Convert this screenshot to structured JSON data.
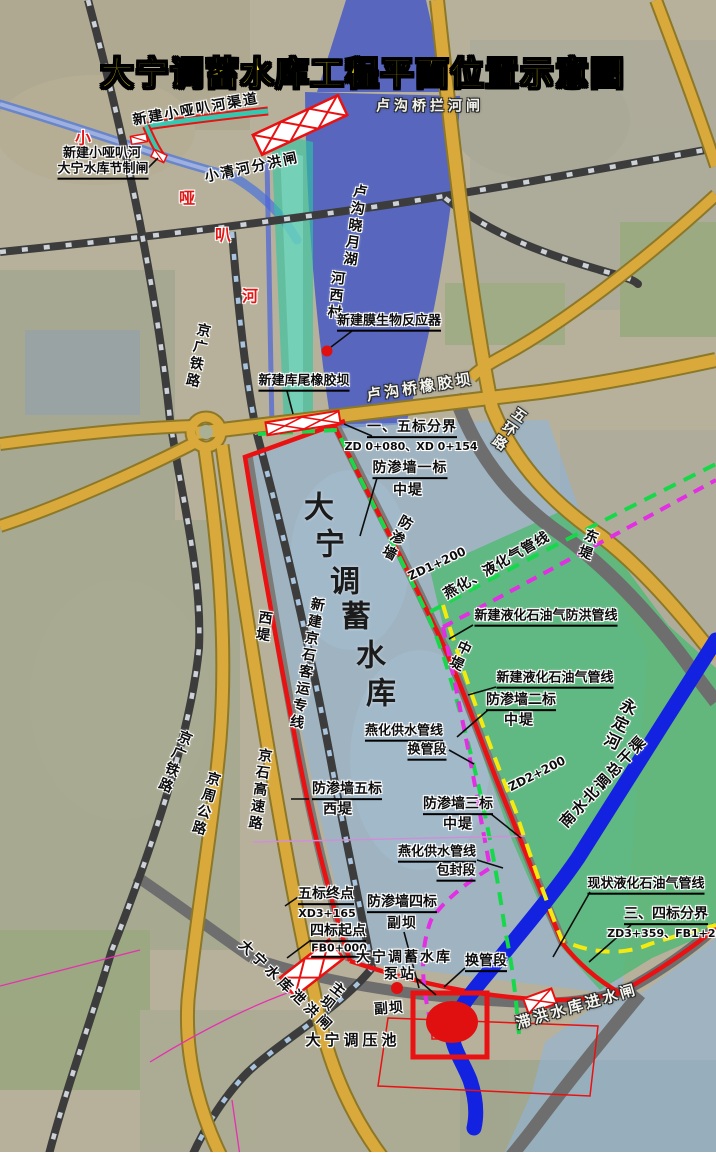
{
  "title": {
    "text": "大宁调蓄水库工程平面位置示意图"
  },
  "colors": {
    "title_yellow": "#ffe400",
    "dike_red": "#e91111",
    "pipeline_green_dashed": "#17d84b",
    "pipeline_magenta_dashed": "#e32ee3",
    "pipeline_yellow_dashed": "#f4ea10",
    "canal_blue": "#1322e0",
    "road_yellow": "#d9a93c",
    "lake_blue": "#4055c5",
    "reservoir_blue": "#8fb4d8",
    "floodplain_green": "#55b877",
    "channel_teal": "#2fc6a3"
  },
  "labels": [
    {
      "n": "label-new-xiaoyaba-channel",
      "t": "新建小哑叭河渠道",
      "x": 196,
      "y": 110,
      "r": -10,
      "c": "dark",
      "fs": 14,
      "ls": 2
    },
    {
      "n": "label-lugouqiao-lanhezha",
      "t": "卢沟桥拦河闸",
      "x": 430,
      "y": 107,
      "c": "white",
      "fs": 14,
      "ls": 4
    },
    {
      "n": "label-xiaoqinghe-fenhongzha",
      "t": "小清河分洪闸",
      "x": 252,
      "y": 168,
      "r": -12,
      "c": "dark",
      "fs": 14,
      "ls": 2
    },
    {
      "n": "label-jiezhizha-line1",
      "t": "新建小哑叭河",
      "x": 102,
      "y": 154,
      "c": "dark",
      "fs": 13
    },
    {
      "n": "label-jiezhizha-line2",
      "t": "大宁水库节制闸",
      "x": 103,
      "y": 171,
      "c": "dark u",
      "fs": 13
    },
    {
      "n": "label-xiaoyaba-he-1",
      "t": "小",
      "x": 83,
      "y": 139,
      "c": "red",
      "fs": 16
    },
    {
      "n": "label-xiaoyaba-he-2",
      "t": "哑",
      "x": 187,
      "y": 199,
      "c": "red",
      "fs": 16
    },
    {
      "n": "label-xiaoyaba-he-3",
      "t": "叭",
      "x": 223,
      "y": 236,
      "c": "red",
      "fs": 16
    },
    {
      "n": "label-xiaoyaba-he-4",
      "t": "河",
      "x": 250,
      "y": 297,
      "c": "red",
      "fs": 16
    },
    {
      "n": "label-hexicun",
      "t": "河西村",
      "x": 335,
      "y": 296,
      "r": 6,
      "c": "dark",
      "fs": 14,
      "v": 1
    },
    {
      "n": "label-lugou-xiaoyue-hu",
      "t": "卢沟晓月湖",
      "x": 354,
      "y": 226,
      "r": 8,
      "c": "dark",
      "fs": 14,
      "v": 1
    },
    {
      "n": "label-membrane-reactor",
      "t": "新建膜生物反应器",
      "x": 389,
      "y": 323,
      "c": "dark u",
      "fs": 13
    },
    {
      "n": "label-kuwei-rubber-dam",
      "t": "新建库尾橡胶坝",
      "x": 304,
      "y": 383,
      "c": "dark u",
      "fs": 13
    },
    {
      "n": "label-lugouqiao-rubber-dam",
      "t": "卢沟桥橡胶坝",
      "x": 420,
      "y": 388,
      "r": -9,
      "c": "white",
      "fs": 15,
      "ls": 3
    },
    {
      "n": "label-wuhuan-road",
      "t": "五环路",
      "x": 508,
      "y": 429,
      "r": 35,
      "c": "white",
      "fs": 14,
      "v": 1
    },
    {
      "n": "label-dongdi",
      "t": "东堤",
      "x": 587,
      "y": 545,
      "r": 20,
      "c": "dark",
      "fs": 14,
      "v": 1
    },
    {
      "n": "label-div-1-5",
      "t": "一、五标分界",
      "x": 412,
      "y": 429,
      "c": "dark u",
      "fs": 14,
      "ls": 1
    },
    {
      "n": "label-div-1-5-code",
      "t": "ZD 0+080、XD 0+154",
      "x": 411,
      "y": 447,
      "c": "dark sm",
      "fs": 11
    },
    {
      "n": "label-cutoff-1",
      "t": "防渗墙一标",
      "x": 410,
      "y": 470,
      "c": "dark u",
      "fs": 14,
      "ls": 1
    },
    {
      "n": "label-cutoff-1-zhongdi",
      "t": "中堤",
      "x": 408,
      "y": 491,
      "c": "dark",
      "fs": 14,
      "ls": 1
    },
    {
      "n": "label-cutoff-vert",
      "t": "防渗墙",
      "x": 396,
      "y": 538,
      "r": 28,
      "c": "dark",
      "fs": 14,
      "v": 1
    },
    {
      "n": "label-zd1-200",
      "t": "ZD1+200",
      "x": 437,
      "y": 564,
      "r": -25,
      "c": "dark sm",
      "fs": 12
    },
    {
      "n": "label-yanhua-lpg-line",
      "t": "燕化、液化气管线",
      "x": 497,
      "y": 566,
      "r": -30,
      "c": "dark",
      "fs": 14,
      "ls": 1
    },
    {
      "n": "label-new-lpg-flood-line",
      "t": "新建液化石油气防洪管线",
      "x": 546,
      "y": 618,
      "c": "dark u",
      "fs": 13
    },
    {
      "n": "label-zhongdi-vert",
      "t": "中堤",
      "x": 459,
      "y": 656,
      "r": 25,
      "c": "dark",
      "fs": 14,
      "v": 1
    },
    {
      "n": "label-new-lpg-line",
      "t": "新建液化石油气管线",
      "x": 555,
      "y": 680,
      "c": "dark u",
      "fs": 13
    },
    {
      "n": "label-cutoff-2",
      "t": "防渗墙二标",
      "x": 521,
      "y": 702,
      "c": "dark u",
      "fs": 14
    },
    {
      "n": "label-cutoff-2-zhongdi",
      "t": "中堤",
      "x": 519,
      "y": 721,
      "c": "dark",
      "fs": 14,
      "ls": 1
    },
    {
      "n": "label-yongdinghe",
      "t": "永定河",
      "x": 618,
      "y": 724,
      "r": 25,
      "c": "dark",
      "fs": 16,
      "v": 1
    },
    {
      "n": "label-yanhua-water-1",
      "t": "燕化供水管线",
      "x": 404,
      "y": 733,
      "c": "dark u",
      "fs": 13
    },
    {
      "n": "label-yanhua-water-2",
      "t": "换管段",
      "x": 427,
      "y": 752,
      "c": "dark u",
      "fs": 13
    },
    {
      "n": "label-zd2-200",
      "t": "ZD2+200",
      "x": 537,
      "y": 774,
      "r": -27,
      "c": "dark sm",
      "fs": 12
    },
    {
      "n": "label-nanshuibeidiao",
      "t": "南水北调总干渠",
      "x": 604,
      "y": 782,
      "r": -47,
      "c": "dark",
      "fs": 15,
      "ls": 2
    },
    {
      "n": "label-cutoff-3",
      "t": "防渗墙三标",
      "x": 458,
      "y": 806,
      "c": "dark u",
      "fs": 14
    },
    {
      "n": "label-cutoff-3-zhongdi",
      "t": "中堤",
      "x": 458,
      "y": 825,
      "c": "dark",
      "fs": 14,
      "ls": 1
    },
    {
      "n": "label-yanhua-encase-1",
      "t": "燕化供水管线",
      "x": 437,
      "y": 854,
      "c": "dark u",
      "fs": 13
    },
    {
      "n": "label-yanhua-encase-2",
      "t": "包封段",
      "x": 456,
      "y": 873,
      "c": "dark u",
      "fs": 13
    },
    {
      "n": "label-cutoff-5",
      "t": "防渗墙五标",
      "x": 347,
      "y": 791,
      "c": "dark u",
      "fs": 14
    },
    {
      "n": "label-cutoff-5-xidi",
      "t": "西堤",
      "x": 338,
      "y": 810,
      "c": "dark",
      "fs": 14,
      "ls": 1
    },
    {
      "n": "label-xidi-vert",
      "t": "西堤",
      "x": 263,
      "y": 627,
      "r": 8,
      "c": "dark",
      "fs": 14,
      "v": 1
    },
    {
      "n": "label-reservoir-char-1",
      "t": "大",
      "x": 319,
      "y": 508,
      "c": "big",
      "fs": 30
    },
    {
      "n": "label-reservoir-char-2",
      "t": "宁",
      "x": 330,
      "y": 545,
      "c": "big",
      "fs": 30
    },
    {
      "n": "label-reservoir-char-3",
      "t": "调",
      "x": 345,
      "y": 582,
      "c": "big",
      "fs": 30
    },
    {
      "n": "label-reservoir-char-4",
      "t": "蓄",
      "x": 356,
      "y": 617,
      "c": "big",
      "fs": 30
    },
    {
      "n": "label-reservoir-char-5",
      "t": "水",
      "x": 371,
      "y": 656,
      "c": "big",
      "fs": 30
    },
    {
      "n": "label-reservoir-char-6",
      "t": "库",
      "x": 381,
      "y": 694,
      "c": "big",
      "fs": 30
    },
    {
      "n": "label-jingshi-hsr",
      "t": "新建京石客运专线",
      "x": 306,
      "y": 664,
      "r": 10,
      "c": "dark",
      "fs": 14,
      "v": 1
    },
    {
      "n": "label-jingguang-railway-1",
      "t": "京广铁路",
      "x": 197,
      "y": 356,
      "r": 12,
      "c": "dark",
      "fs": 14,
      "v": 1
    },
    {
      "n": "label-jingguang-railway-2",
      "t": "京广铁路",
      "x": 174,
      "y": 762,
      "r": 22,
      "c": "dark",
      "fs": 14,
      "v": 1
    },
    {
      "n": "label-jingzhou-road",
      "t": "京周公路",
      "x": 205,
      "y": 804,
      "r": 16,
      "c": "dark",
      "fs": 14,
      "v": 1
    },
    {
      "n": "label-jingshi-expressway",
      "t": "京石高速路",
      "x": 259,
      "y": 790,
      "r": 8,
      "c": "dark",
      "fs": 14,
      "v": 1
    },
    {
      "n": "label-seg5-end",
      "t": "五标终点",
      "x": 326,
      "y": 896,
      "c": "dark u",
      "fs": 14
    },
    {
      "n": "label-seg5-end-code",
      "t": "XD3+165",
      "x": 327,
      "y": 914,
      "c": "dark sm",
      "fs": 11
    },
    {
      "n": "label-seg4-start",
      "t": "四标起点",
      "x": 338,
      "y": 933,
      "c": "dark u",
      "fs": 14
    },
    {
      "n": "label-seg4-start-code",
      "t": "FB0+000",
      "x": 339,
      "y": 950,
      "c": "dark sm u",
      "fs": 11
    },
    {
      "n": "label-cutoff-4",
      "t": "防渗墙四标",
      "x": 402,
      "y": 904,
      "c": "dark u",
      "fs": 14
    },
    {
      "n": "label-cutoff-4-fuba",
      "t": "副坝",
      "x": 402,
      "y": 924,
      "c": "dark",
      "fs": 14,
      "ls": 1
    },
    {
      "n": "label-pump-station-1",
      "t": "大宁调蓄水库",
      "x": 404,
      "y": 958,
      "c": "dark",
      "fs": 14,
      "ls": 2
    },
    {
      "n": "label-pump-station-2",
      "t": "泵站",
      "x": 400,
      "y": 975,
      "c": "dark",
      "fs": 14,
      "ls": 2
    },
    {
      "n": "label-huanguanduan",
      "t": "换管段",
      "x": 486,
      "y": 963,
      "c": "dark u",
      "fs": 14
    },
    {
      "n": "label-zhuba",
      "t": "主坝",
      "x": 331,
      "y": 996,
      "r": 38,
      "c": "dark",
      "fs": 14,
      "v": 1
    },
    {
      "n": "label-fuba",
      "t": "副坝",
      "x": 389,
      "y": 1009,
      "r": -4,
      "c": "dark",
      "fs": 14,
      "ls": 1
    },
    {
      "n": "label-tiaoyachi",
      "t": "大宁调压池",
      "x": 353,
      "y": 1041,
      "c": "dark",
      "fs": 15,
      "ls": 4
    },
    {
      "n": "label-existing-lpg-line",
      "t": "现状液化石油气管线",
      "x": 646,
      "y": 886,
      "c": "dark u",
      "fs": 13
    },
    {
      "n": "label-div-3-4",
      "t": "三、四标分界",
      "x": 666,
      "y": 916,
      "c": "dark u",
      "fs": 14
    },
    {
      "n": "label-div-3-4-code",
      "t": "ZD3+359、FB1+262",
      "x": 669,
      "y": 934,
      "c": "dark sm",
      "fs": 11
    },
    {
      "n": "label-zhihong-intake-gate",
      "t": "滞洪水库进水闸",
      "x": 577,
      "y": 1007,
      "r": -16,
      "c": "white",
      "fs": 15,
      "ls": 3
    },
    {
      "n": "label-daning-xiehongzha",
      "t": "大宁水库泄洪闸",
      "x": 286,
      "y": 987,
      "r": 44,
      "c": "dark",
      "fs": 14,
      "ls": 4
    }
  ],
  "leaders": [
    [
      352,
      331,
      331,
      347
    ],
    [
      287,
      391,
      293,
      414
    ],
    [
      372,
      436,
      344,
      424
    ],
    [
      377,
      478,
      360,
      536
    ],
    [
      473,
      625,
      449,
      639
    ],
    [
      496,
      687,
      468,
      695
    ],
    [
      488,
      710,
      457,
      737
    ],
    [
      449,
      750,
      474,
      764
    ],
    [
      491,
      814,
      521,
      838
    ],
    [
      477,
      860,
      503,
      868
    ],
    [
      309,
      799,
      291,
      799
    ],
    [
      298,
      897,
      285,
      906
    ],
    [
      311,
      940,
      287,
      958
    ],
    [
      404,
      932,
      419,
      988
    ],
    [
      416,
      978,
      436,
      995
    ],
    [
      465,
      968,
      444,
      987
    ],
    [
      590,
      892,
      553,
      957
    ],
    [
      631,
      925,
      589,
      962
    ],
    [
      146,
      170,
      158,
      158
    ]
  ]
}
